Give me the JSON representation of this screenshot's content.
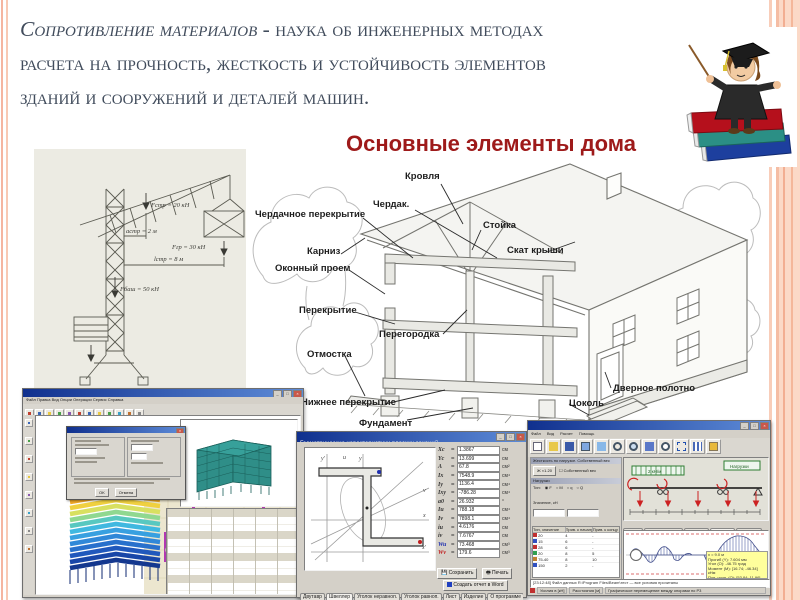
{
  "slide": {
    "title_em": "Сопротивление материалов",
    "title_line1_rest": " - наука об инженерных методах",
    "title_line2": "расчета на прочность, жесткость и устойчивость элементов",
    "title_line3": "зданий и сооружений и деталей машин.",
    "heading": "Основные элементы дома",
    "colors": {
      "accent_red": "#9e1a1a",
      "title_gray": "#414c5c",
      "border_salmon": "#f5b5a0"
    }
  },
  "crane": {
    "annotations": {
      "f_str": "Fстр = 20 кН",
      "a_str": "aстр = 2 м",
      "f_gr": "Fгр = 30 кН",
      "l_str": "lстр = 8 м",
      "f_bash": "Fбаш = 50 кН"
    },
    "supports": {
      "a": "A",
      "b": "B"
    }
  },
  "house": {
    "labels": [
      {
        "text": "Кровля"
      },
      {
        "text": "Чердак."
      },
      {
        "text": "Чердачное перекрытие"
      },
      {
        "text": "Стойка"
      },
      {
        "text": "Скат крыши"
      },
      {
        "text": "Карниз"
      },
      {
        "text": "Оконный проем"
      },
      {
        "text": "Перекрытие"
      },
      {
        "text": "Перегородка"
      },
      {
        "text": "Отмостка"
      },
      {
        "text": "Нижнее перекрытие"
      },
      {
        "text": "Фундамент"
      },
      {
        "text": "Дверное полотно"
      },
      {
        "text": "Цоколь"
      }
    ]
  },
  "windows": {
    "scad": {
      "menu": "Файл  Правка  Вид  Опции  Операции  Сервис  Справка",
      "dialog": {
        "ok": "OK",
        "cancel": "Отмена"
      }
    },
    "section": {
      "title": "Геометрические характеристики плоских сечений",
      "axes": [
        "y'",
        "u",
        "y",
        "v",
        "x",
        "x'"
      ],
      "props": [
        {
          "n": "Xc",
          "v": "1.3867",
          "u": "см"
        },
        {
          "n": "Yc",
          "v": "13.699",
          "u": "см"
        },
        {
          "n": "A",
          "v": "67.8",
          "u": "см²"
        },
        {
          "n": "Ix",
          "v": "7548.9",
          "u": "см⁴"
        },
        {
          "n": "Iy",
          "v": "1136.4",
          "u": "см⁴"
        },
        {
          "n": "Ixy",
          "v": "-786.28",
          "u": "см⁴"
        },
        {
          "n": "a0",
          "v": "26.932",
          "u": "°"
        },
        {
          "n": "Iu",
          "v": "788.18",
          "u": "см⁴"
        },
        {
          "n": "Iv",
          "v": "7898.1",
          "u": "см⁴"
        },
        {
          "n": "iu",
          "v": "4.6176",
          "u": "см"
        },
        {
          "n": "iv",
          "v": "7.6767",
          "u": "см"
        },
        {
          "n": "Wu",
          "v": "73.468",
          "u": "см³"
        },
        {
          "n": "Wv",
          "v": "179.6",
          "u": "см³"
        }
      ],
      "save_btn": "Сохранить",
      "print_btn": "Печать",
      "report_chk": "Создать отчет в Word",
      "tabs": [
        "Двутавр",
        "Швеллер",
        "Уголок неравноп.",
        "Уголок равноп.",
        "Лист",
        "Изделие",
        "О программе"
      ]
    },
    "beam": {
      "title": "Beam v.2.1.0.164",
      "menu": [
        "Файл",
        "Вид",
        "Расчет",
        "Помощь"
      ],
      "left": {
        "caption": "Жесткость по нагрузке. Собственный вес",
        "stiff_btn": "Ж ×1.20",
        "ownweight": "Собственный вес",
        "loads_caption": "Нагрузки",
        "type_label": "Тип:",
        "radios": [
          "F",
          "M",
          "q",
          "Q"
        ],
        "value_label": "Значение, кН",
        "anchor_label": "Привязка, м",
        "table_caption": "Приложенные на балку нагрузки",
        "table_headers": [
          "Тип, значение",
          "Прив. к началу",
          "Прив. к концу"
        ],
        "rows": [
          {
            "v": "20",
            "a": "4",
            "b": "-"
          },
          {
            "v": "15",
            "a": "6",
            "b": "-"
          },
          {
            "v": "28",
            "a": "6",
            "b": "-"
          },
          {
            "v": "20",
            "a": "8",
            "b": "5"
          },
          {
            "v": "75-40",
            "a": "8",
            "b": "10"
          },
          {
            "v": "150",
            "a": "2",
            "b": "-"
          }
        ]
      },
      "scene": {
        "dist_load": "2 кН/м",
        "legend": "Нагрузки"
      },
      "tabs": [
        "Расчет",
        "Эпюра нагрузок",
        "Эпюра Q",
        "Эпюра M",
        "Документ"
      ],
      "tooltip": [
        "x = 9.0 м",
        "Прогиб (Y): 7.604 мм",
        "Угол (O): -46.75 град",
        "Момент (M): [16.74; -46.34] кНм",
        "Поп. усил. (Q): [53.84; 11.96] кН"
      ],
      "log": "[23:12:48] Файл данных R:\\Program Files\\Beam\\тест — все условия прочитаны",
      "status": [
        "Усилия в [кН]",
        "Расстояния [м]",
        "Графическое перемещение между опорами по P3"
      ]
    }
  }
}
